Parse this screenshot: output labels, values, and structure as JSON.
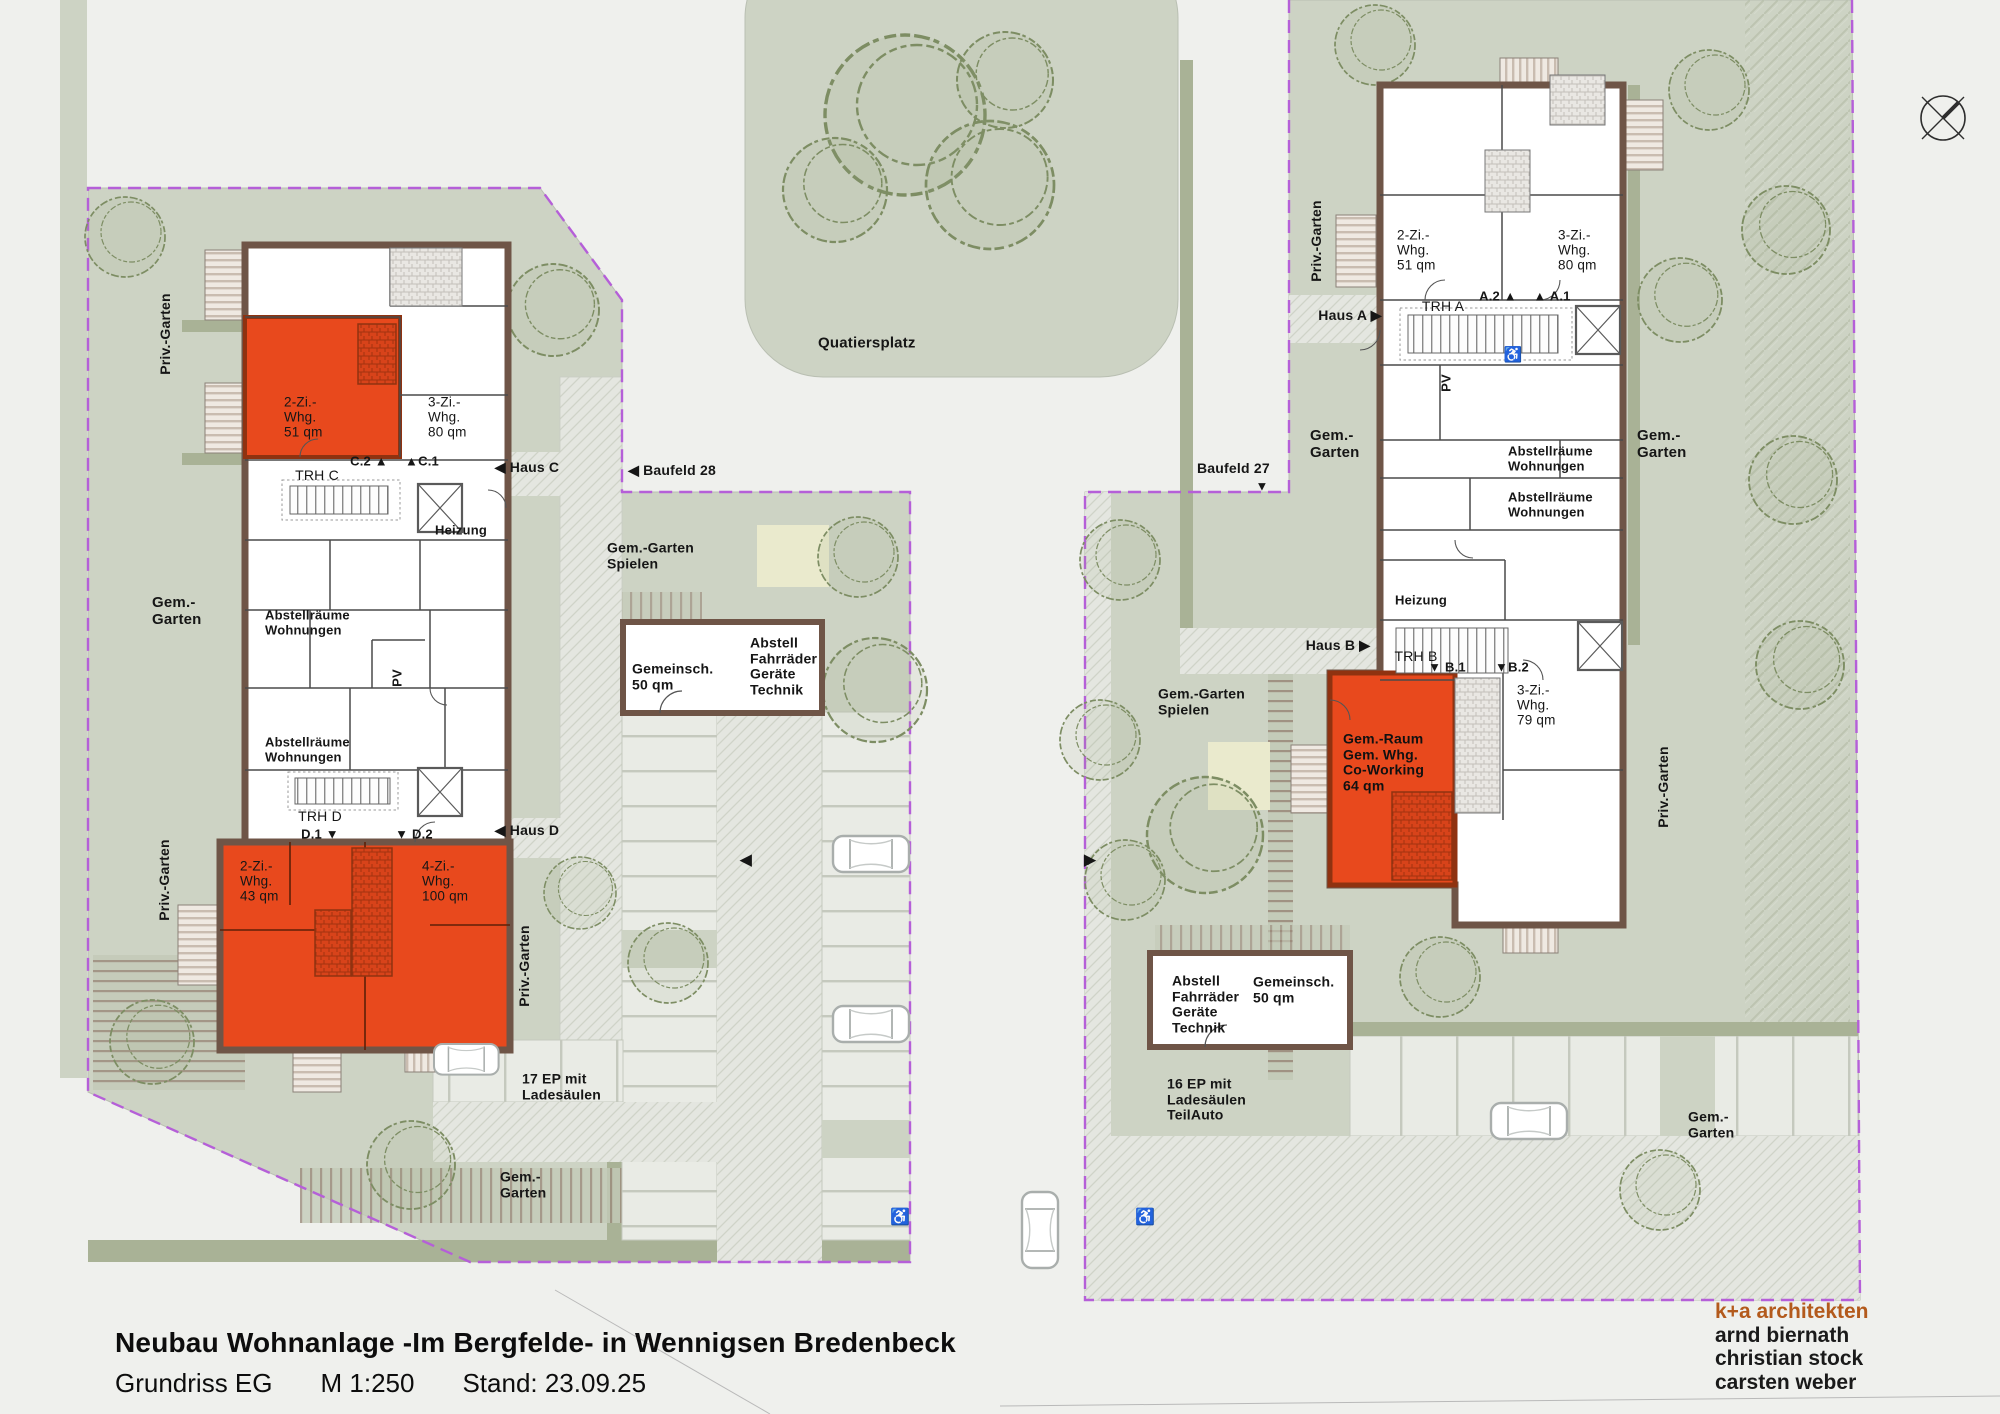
{
  "title_block": {
    "title": "Neubau Wohnanlage -Im Bergfelde- in Wennigsen Bredenbeck",
    "plan_name": "Grundriss EG",
    "scale": "M 1:250",
    "date": "Stand: 23.09.25"
  },
  "architects": {
    "firm": "k+a architekten",
    "names": [
      "arnd biernath",
      "christian stock",
      "carsten weber"
    ],
    "firm_color": "#b35a1c"
  },
  "compass": {
    "label": "N"
  },
  "colors": {
    "road_gray": "#eff0ed",
    "parcel_green": "#cdd3c4",
    "hedge_green": "#a9b296",
    "apartment_orange": "#e8491d",
    "wall_brown": "#6f5547",
    "boundary_purple": "#b55fd8",
    "paving_gray": "#e9ebe5",
    "play_yellow": "#eaeacd"
  },
  "labels": [
    {
      "id": "priv-garten-nw-label",
      "t": "Priv.-Garten",
      "x": 166,
      "y": 334,
      "rot": -90,
      "size": 14
    },
    {
      "id": "gem-garten-w-label",
      "t": "Gem.-\nGarten",
      "x": 152,
      "y": 612,
      "align": "left",
      "size": 15
    },
    {
      "id": "priv-garten-sw-label",
      "t": "Priv.-Garten",
      "x": 165,
      "y": 880,
      "rot": -90,
      "size": 14
    },
    {
      "id": "whg-2zi-51-c-label",
      "t": "2-Zi.-\nWhg.\n51 qm",
      "x": 284,
      "y": 417,
      "align": "left",
      "size": 13.5,
      "bold": false
    },
    {
      "id": "whg-3zi-80-c-label",
      "t": "3-Zi.-\nWhg.\n80 qm",
      "x": 428,
      "y": 417,
      "align": "left",
      "size": 13.5,
      "bold": false
    },
    {
      "id": "mark-c2",
      "t": "C.2 ▲",
      "x": 369,
      "y": 462,
      "size": 13
    },
    {
      "id": "mark-c1",
      "t": "▲C.1",
      "x": 422,
      "y": 462,
      "size": 13
    },
    {
      "id": "trh-c-label",
      "t": "TRH C",
      "x": 317,
      "y": 476,
      "size": 14,
      "bold": false
    },
    {
      "id": "haus-c-label",
      "t": "◀ Haus C",
      "x": 527,
      "y": 468,
      "size": 14
    },
    {
      "id": "baufeld-28-label",
      "t": "◀ Baufeld  28",
      "x": 672,
      "y": 471,
      "size": 14
    },
    {
      "id": "heizung-c-label",
      "t": "Heizung",
      "x": 461,
      "y": 531,
      "size": 13
    },
    {
      "id": "abstellraeume-c1-label",
      "t": "Abstellräume\nWohnungen",
      "x": 265,
      "y": 623,
      "align": "left",
      "size": 13
    },
    {
      "id": "pv-c-label",
      "t": "PV",
      "x": 398,
      "y": 678,
      "rot": -90,
      "size": 13
    },
    {
      "id": "abstellraeume-c2-label",
      "t": "Abstellräume\nWohnungen",
      "x": 265,
      "y": 750,
      "align": "left",
      "size": 13
    },
    {
      "id": "trh-d-label",
      "t": "TRH D",
      "x": 320,
      "y": 817,
      "size": 14,
      "bold": false
    },
    {
      "id": "mark-d1",
      "t": "D.1 ▼",
      "x": 320,
      "y": 835,
      "size": 13
    },
    {
      "id": "mark-d2",
      "t": "▼ D.2",
      "x": 414,
      "y": 835,
      "size": 13
    },
    {
      "id": "haus-d-label",
      "t": "◀ Haus D",
      "x": 527,
      "y": 831,
      "size": 14
    },
    {
      "id": "whg-2zi-43-d-label",
      "t": "2-Zi.-\nWhg.\n43 qm",
      "x": 240,
      "y": 881,
      "align": "left",
      "size": 13.5,
      "bold": false
    },
    {
      "id": "whg-4zi-100-d-label",
      "t": "4-Zi.-\nWhg.\n100 qm",
      "x": 422,
      "y": 881,
      "align": "left",
      "size": 13.5,
      "bold": false
    },
    {
      "id": "priv-garten-d-e-label",
      "t": "Priv.-Garten",
      "x": 525,
      "y": 966,
      "rot": -90,
      "size": 14
    },
    {
      "id": "gem-garten-spielen-w-label",
      "t": "Gem.-Garten\nSpielen",
      "x": 607,
      "y": 556,
      "align": "left",
      "size": 14
    },
    {
      "id": "gemeinsch-50-w-label",
      "t": "Gemeinsch.\n50 qm",
      "x": 632,
      "y": 677,
      "align": "left",
      "size": 14
    },
    {
      "id": "abstell-w-label",
      "t": "Abstell\nFahrräder\nGeräte\nTechnik",
      "x": 750,
      "y": 667,
      "align": "left",
      "size": 14
    },
    {
      "id": "ep-17-label",
      "t": "17 EP mit\nLadesäulen",
      "x": 522,
      "y": 1087,
      "align": "left",
      "size": 14
    },
    {
      "id": "gem-garten-s-label",
      "t": "Gem.-\nGarten",
      "x": 500,
      "y": 1185,
      "align": "left",
      "size": 14
    },
    {
      "id": "section-arrow-w",
      "t": "◀",
      "x": 746,
      "y": 861,
      "size": 15
    },
    {
      "id": "quatiersplatz-label",
      "t": "Quatiersplatz",
      "x": 818,
      "y": 344,
      "align": "left",
      "size": 15
    },
    {
      "id": "baufeld-27-label",
      "t": "Baufeld  27",
      "x": 1197,
      "y": 469,
      "align": "left",
      "size": 14
    },
    {
      "id": "baufeld-27-arrow",
      "t": "▼",
      "x": 1262,
      "y": 487,
      "size": 13
    },
    {
      "id": "priv-garten-a-w-label",
      "t": "Priv.-Garten",
      "x": 1317,
      "y": 241,
      "rot": -90,
      "size": 14
    },
    {
      "id": "whg-2zi-51-a-label",
      "t": "2-Zi.-\nWhg.\n51 qm",
      "x": 1397,
      "y": 250,
      "align": "left",
      "size": 13.5,
      "bold": false
    },
    {
      "id": "whg-3zi-80-a-label",
      "t": "3-Zi.-\nWhg.\n80 qm",
      "x": 1558,
      "y": 250,
      "align": "left",
      "size": 13.5,
      "bold": false
    },
    {
      "id": "mark-a2",
      "t": "A.2 ▲",
      "x": 1498,
      "y": 297,
      "size": 13
    },
    {
      "id": "mark-a1",
      "t": "▲ A.1",
      "x": 1552,
      "y": 297,
      "size": 13
    },
    {
      "id": "trh-a-label",
      "t": "TRH A",
      "x": 1443,
      "y": 307,
      "size": 14,
      "bold": false
    },
    {
      "id": "haus-a-label",
      "t": "Haus A ▶",
      "x": 1350,
      "y": 316,
      "size": 14
    },
    {
      "id": "pv-a-label",
      "t": "PV",
      "x": 1447,
      "y": 383,
      "rot": -90,
      "size": 13
    },
    {
      "id": "accessible-icon-trh-a",
      "t": "♿",
      "x": 1513,
      "y": 356,
      "size": 15,
      "color": "#555"
    },
    {
      "id": "gem-garten-a-w-label",
      "t": "Gem.-\nGarten",
      "x": 1310,
      "y": 445,
      "align": "left",
      "size": 15
    },
    {
      "id": "gem-garten-a-e-label",
      "t": "Gem.-\nGarten",
      "x": 1637,
      "y": 445,
      "align": "left",
      "size": 15
    },
    {
      "id": "abstellraeume-a1-label",
      "t": "Abstellräume\nWohnungen",
      "x": 1508,
      "y": 459,
      "align": "left",
      "size": 13
    },
    {
      "id": "abstellraeume-a2-label",
      "t": "Abstellräume\nWohnungen",
      "x": 1508,
      "y": 505,
      "align": "left",
      "size": 13
    },
    {
      "id": "heizung-b-label",
      "t": "Heizung",
      "x": 1421,
      "y": 601,
      "size": 13
    },
    {
      "id": "haus-b-label",
      "t": "Haus B ▶",
      "x": 1338,
      "y": 646,
      "size": 14
    },
    {
      "id": "trh-b-label",
      "t": "TRH B",
      "x": 1416,
      "y": 657,
      "size": 14,
      "bold": false
    },
    {
      "id": "mark-b1",
      "t": "▼ B.1",
      "x": 1447,
      "y": 668,
      "size": 13
    },
    {
      "id": "mark-b2",
      "t": "▼B.2",
      "x": 1512,
      "y": 668,
      "size": 13
    },
    {
      "id": "gem-garten-spielen-e-label",
      "t": "Gem.-Garten\nSpielen",
      "x": 1158,
      "y": 702,
      "align": "left",
      "size": 14
    },
    {
      "id": "gem-raum-label",
      "t": "Gem.-Raum\nGem. Whg.\nCo-Working\n64 qm",
      "x": 1343,
      "y": 763,
      "align": "left",
      "size": 14,
      "color": "#111"
    },
    {
      "id": "whg-3zi-79-b-label",
      "t": "3-Zi.-\nWhg.\n79 qm",
      "x": 1517,
      "y": 705,
      "align": "left",
      "size": 13.5,
      "bold": false
    },
    {
      "id": "priv-garten-b-e-label",
      "t": "Priv.-Garten",
      "x": 1664,
      "y": 787,
      "rot": -90,
      "size": 14
    },
    {
      "id": "abstell-e-label",
      "t": "Abstell\nFahrräder\nGeräte\nTechnik",
      "x": 1172,
      "y": 1005,
      "align": "left",
      "size": 14
    },
    {
      "id": "gemeinsch-50-e-label",
      "t": "Gemeinsch.\n50 qm",
      "x": 1253,
      "y": 990,
      "align": "left",
      "size": 14
    },
    {
      "id": "ep-16-label",
      "t": "16 EP mit\nLadesäulen\nTeilAuto",
      "x": 1167,
      "y": 1100,
      "align": "left",
      "size": 14
    },
    {
      "id": "gem-garten-se-label",
      "t": "Gem.-\nGarten",
      "x": 1688,
      "y": 1125,
      "align": "left",
      "size": 14
    },
    {
      "id": "section-arrow-e",
      "t": "▶",
      "x": 1090,
      "y": 861,
      "size": 15
    },
    {
      "id": "accessible-icon-road-1",
      "t": "♿",
      "x": 900,
      "y": 1218,
      "size": 16,
      "color": "#a8adab"
    },
    {
      "id": "accessible-icon-road-2",
      "t": "♿",
      "x": 1145,
      "y": 1218,
      "size": 16,
      "color": "#a8adab"
    }
  ]
}
